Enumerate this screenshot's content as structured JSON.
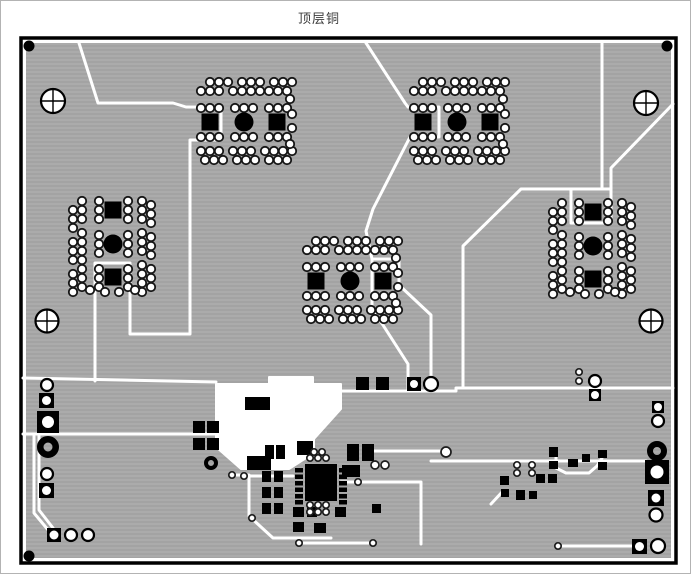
{
  "title": "顶层铜",
  "colors": {
    "background": "#ffffff",
    "frame_border": "#b3b3b3",
    "board_outline": "#000000",
    "copper_dark": "#a3a3a3",
    "copper_light": "#ababab",
    "clearance": "#ffffff",
    "pad_black": "#000000",
    "pad_ring": "#161616",
    "title_text": "#3c3c3c"
  },
  "pcb": {
    "board": {
      "x": 20,
      "y": 37,
      "w": 655,
      "h": 525,
      "border_w": 3.5,
      "copper_inset": 5
    },
    "crosshair_holes": [
      [
        52,
        100,
        12
      ],
      [
        645,
        102,
        12
      ],
      [
        46,
        320,
        11.5
      ],
      [
        650,
        320,
        11.5
      ]
    ],
    "corner_dots": [
      [
        28,
        45,
        5.5
      ],
      [
        666,
        45,
        5.5
      ],
      [
        28,
        555,
        5.5
      ]
    ],
    "clusters": [
      {
        "cx": 243,
        "cy": 121,
        "orient": "h"
      },
      {
        "cx": 456,
        "cy": 121,
        "orient": "h"
      },
      {
        "cx": 349,
        "cy": 280,
        "orient": "h"
      },
      {
        "cx": 112,
        "cy": 243,
        "orient": "v"
      },
      {
        "cx": 592,
        "cy": 245,
        "orient": "v"
      }
    ],
    "cluster_pattern": {
      "pad_r": 4.2,
      "outer_rows": [
        {
          "d": -40,
          "p": [
            -34,
            -25,
            -16,
            -2,
            7,
            16,
            30,
            39,
            48
          ]
        },
        {
          "d": -31,
          "p": [
            -43,
            -34,
            -25,
            -11,
            -2,
            7,
            16,
            25,
            34,
            43
          ]
        },
        {
          "d": 29,
          "p": [
            -43,
            -34,
            -25,
            -11,
            -2,
            7,
            21,
            30,
            39,
            48
          ]
        },
        {
          "d": 38,
          "p": [
            -39,
            -30,
            -21,
            -7,
            2,
            11,
            25,
            34,
            43
          ]
        }
      ],
      "inner_rows": [
        {
          "d": -14,
          "p": [
            -43,
            -34,
            -25,
            -9,
            0,
            9,
            25,
            34,
            43
          ]
        },
        {
          "d": 15,
          "p": [
            -43,
            -34,
            -25,
            -9,
            0,
            9,
            25,
            34,
            43
          ]
        }
      ],
      "extras": [
        [
          46,
          -23
        ],
        [
          48,
          -8
        ],
        [
          48,
          6
        ],
        [
          46,
          22
        ]
      ],
      "square_offsets": [
        -34,
        33
      ],
      "square_size": 17,
      "circle_r": 9.5
    },
    "traces": [
      "M78,42 L97,102 H172 L185,106 H220 V139 H189 V333 H129 V262 H94 V380",
      "M365,42 L404,102 L407,106 H438 V136 H409 L372,208 L365,230 L371,258",
      "M371,258 H398 V284 L430,314 V390",
      "M371,258 V307 L407,363 V390",
      "M601,42 V188",
      "M672,103 L610,167 V188 H520 L462,245 V387",
      "M570,188 V222 H610 V188",
      "M22,377 L215,381",
      "M340,390 H455 V387 H672",
      "M22,433 H215",
      "M430,460 H645",
      "M557,545 H638",
      "M33,435 V512 L48,530",
      "M38,435 V509 L52,527",
      "M231,474 H248 V515 L272,537 H330",
      "M248,475 H292",
      "M340,481 H420 V543",
      "M367,450 H440",
      "M298,542 H372",
      "M555,455 V467 L565,472 H588 L596,465 L601,457",
      "M502,490 L490,503"
    ],
    "clearance_blob": "215,383 268,383 268,376 312,376 312,383 340,383 340,408 313,438 313,452 288,468 240,468 215,446",
    "solid_rects": [
      [
        244,
        396,
        25,
        13
      ],
      [
        192,
        420,
        12,
        12
      ],
      [
        206,
        420,
        12,
        12
      ],
      [
        192,
        437,
        12,
        12
      ],
      [
        206,
        437,
        12,
        12
      ],
      [
        246,
        455,
        24,
        14
      ],
      [
        296,
        440,
        16,
        14
      ],
      [
        264,
        444,
        9,
        14
      ],
      [
        275,
        444,
        9,
        14
      ],
      [
        346,
        443,
        12,
        17
      ],
      [
        361,
        443,
        12,
        17
      ],
      [
        341,
        464,
        18,
        12
      ],
      [
        261,
        470,
        9,
        11
      ],
      [
        273,
        470,
        9,
        11
      ],
      [
        261,
        486,
        9,
        11
      ],
      [
        273,
        486,
        9,
        11
      ],
      [
        261,
        502,
        9,
        11
      ],
      [
        273,
        502,
        9,
        11
      ],
      [
        292,
        506,
        11,
        10
      ],
      [
        306,
        506,
        10,
        10
      ],
      [
        292,
        521,
        11,
        10
      ],
      [
        313,
        522,
        12,
        10
      ],
      [
        334,
        506,
        11,
        10
      ],
      [
        371,
        503,
        9,
        9
      ],
      [
        355,
        376,
        13,
        13
      ],
      [
        375,
        376,
        13,
        13
      ],
      [
        548,
        446,
        9,
        10
      ],
      [
        548,
        460,
        9,
        8
      ],
      [
        567,
        458,
        10,
        8
      ],
      [
        581,
        453,
        8,
        8
      ],
      [
        597,
        449,
        9,
        8
      ],
      [
        597,
        461,
        9,
        8
      ],
      [
        535,
        473,
        9,
        9
      ],
      [
        547,
        473,
        9,
        9
      ],
      [
        499,
        475,
        9,
        9
      ],
      [
        515,
        489,
        9,
        10
      ],
      [
        528,
        490,
        8,
        8
      ],
      [
        500,
        488,
        8,
        8
      ]
    ],
    "hole_squares": [
      [
        38,
        392,
        15,
        4.5
      ],
      [
        36,
        410,
        22,
        6
      ],
      [
        38,
        482,
        15,
        4.5
      ],
      [
        46,
        527,
        14,
        4.5
      ],
      [
        406,
        376,
        14,
        4
      ],
      [
        588,
        388,
        12,
        4
      ],
      [
        651,
        400,
        12,
        4
      ],
      [
        644,
        459,
        24,
        6.5
      ],
      [
        647,
        489,
        16,
        4.5
      ],
      [
        631,
        538,
        15,
        4.5
      ]
    ],
    "circle_pads": [
      [
        46,
        384,
        6
      ],
      [
        46,
        473,
        6
      ],
      [
        70,
        534,
        6
      ],
      [
        87,
        534,
        6
      ],
      [
        430,
        383,
        7
      ],
      [
        594,
        380,
        6
      ],
      [
        657,
        420,
        6
      ],
      [
        655,
        514,
        6.5
      ],
      [
        657,
        545,
        7
      ]
    ],
    "ring_pads": [
      [
        47,
        446,
        11,
        4.5
      ],
      [
        656,
        450,
        10,
        4
      ],
      [
        210,
        462,
        7,
        3
      ]
    ],
    "vias": [
      [
        231,
        474
      ],
      [
        243,
        475
      ],
      [
        251,
        517
      ],
      [
        298,
        542
      ],
      [
        357,
        481
      ],
      [
        372,
        542
      ],
      [
        516,
        464
      ],
      [
        516,
        472
      ],
      [
        531,
        464
      ],
      [
        531,
        472
      ],
      [
        578,
        371
      ],
      [
        578,
        380
      ],
      [
        557,
        545
      ],
      [
        374,
        464,
        4
      ],
      [
        384,
        464,
        4
      ],
      [
        445,
        451,
        5
      ],
      [
        313,
        451
      ],
      [
        321,
        451
      ],
      [
        309,
        457
      ],
      [
        317,
        457
      ],
      [
        325,
        457
      ],
      [
        309,
        504
      ],
      [
        317,
        504
      ],
      [
        325,
        504
      ],
      [
        309,
        511
      ],
      [
        317,
        511
      ],
      [
        325,
        511
      ]
    ],
    "ic": {
      "body": [
        304,
        463,
        32,
        37
      ],
      "pin_w": 8,
      "pin_h": 4.5,
      "left_x": 294,
      "right_x": 338,
      "pin_ys": [
        467,
        473.5,
        480,
        486.5,
        493,
        499
      ]
    }
  }
}
